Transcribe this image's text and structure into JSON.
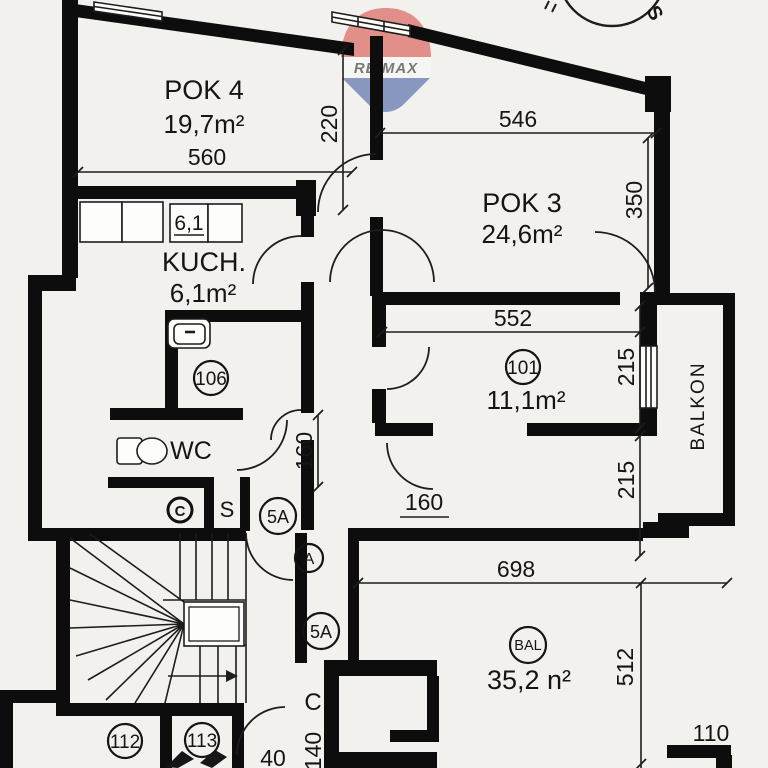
{
  "colors": {
    "bg": "#f2f1ee",
    "wall": "#0d0d0d",
    "logo_red": "#d6403a",
    "logo_blue": "#32519e"
  },
  "logo": {
    "brand": "RE/MAX"
  },
  "compass": {
    "south": "S"
  },
  "rooms": {
    "pok4": {
      "name": "POK 4",
      "area": "19,7m²"
    },
    "pok3": {
      "name": "POK 3",
      "area": "24,6m²"
    },
    "kuch": {
      "name": "KUCH.",
      "area": "6,1m²",
      "cabinet_tag": "6,1"
    },
    "wc": {
      "name": "WC"
    },
    "r101": {
      "number": "101",
      "area": "11,1m²"
    },
    "bal": {
      "number": "BAL",
      "area": "35,2 n²"
    },
    "balkon": {
      "name": "BALKON"
    },
    "r106": {
      "number": "106"
    },
    "r112": {
      "number": "112"
    },
    "r113": {
      "number": "113"
    }
  },
  "tags": {
    "door_a": "A",
    "door_5a_upper": "5A",
    "door_5a_lower": "5A",
    "corridor_c": "C",
    "shaft_s": "S",
    "boiler_c": "C"
  },
  "dims": {
    "pok4_width": "560",
    "pok4_depth": "220",
    "pok3_width": "546",
    "pok3_depth": "350",
    "r101_width": "552",
    "r101_depth_a": "215",
    "r101_depth_b": "215",
    "hall_v": "160",
    "hall_h": "160",
    "bal_width": "698",
    "bal_depth": "512",
    "bal_step": "110",
    "corridor_w": "140",
    "bottom_cut": "40"
  }
}
